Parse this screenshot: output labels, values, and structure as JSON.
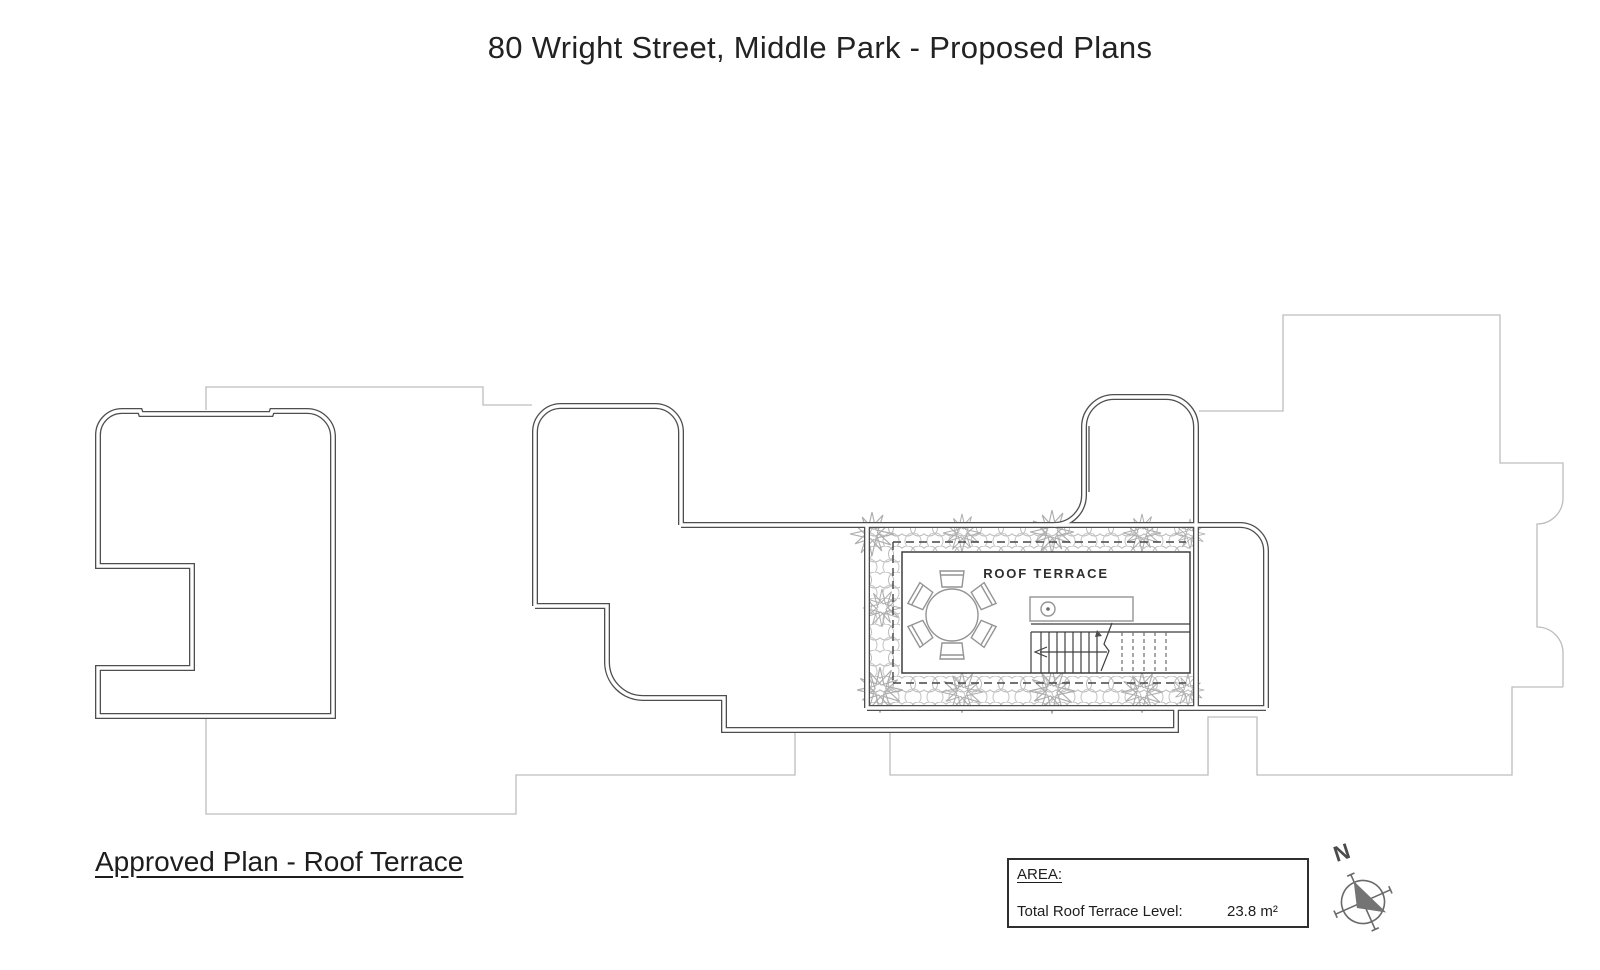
{
  "title": "80 Wright Street, Middle Park - Proposed Plans",
  "plan": {
    "room_label": "ROOF TERRACE"
  },
  "caption": "Approved Plan - Roof Terrace",
  "area_box": {
    "heading": "AREA:",
    "row_label": "Total Roof Terrace Level:",
    "value": "23.8 m²"
  },
  "compass": {
    "north_label": "N"
  },
  "colors": {
    "wall": "#4e4e4e",
    "neighbor": "#bdbdbd",
    "hedge": "#b6b6b6",
    "furn": "#949494",
    "line": "#3e3e3e",
    "ink": "#262626"
  }
}
